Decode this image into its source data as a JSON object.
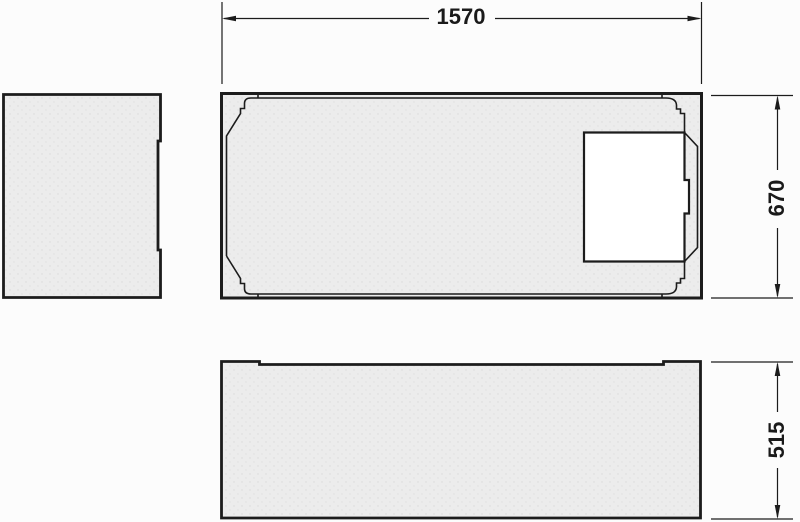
{
  "dimensions": {
    "width_mm": "1570",
    "depth_mm": "670",
    "height_mm": "515"
  },
  "colors": {
    "line": "#1c1c1c",
    "panel_fill": "#ececec",
    "cutout_fill": "#ffffff",
    "background": "#fcfcfc"
  }
}
